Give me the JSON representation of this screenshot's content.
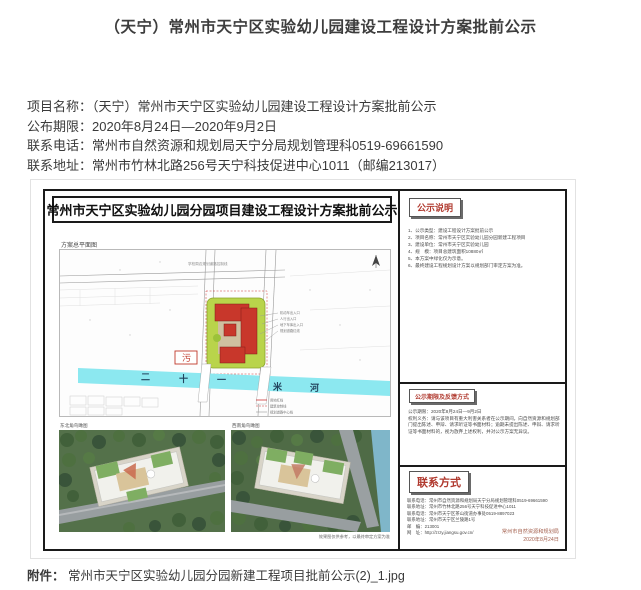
{
  "page": {
    "title": "（天宁）常州市天宁区实验幼儿园建设工程设计方案批前公示",
    "info": [
      {
        "label": "项目名称：",
        "value": "（天宁）常州市天宁区实验幼儿园建设工程设计方案批前公示"
      },
      {
        "label": "公布期限：",
        "value": "2020年8月24日—2020年9月2日"
      },
      {
        "label": "联系电话：",
        "value": "常州市自然资源和规划局天宁分局规划管理科0519-69661590"
      },
      {
        "label": "联系地址：",
        "value": "常州市竹林北路256号天宁科技促进中心1011（邮编213017）"
      }
    ],
    "attachment_label": "附件：",
    "attachment_name": "常州市天宁区实验幼儿园分园新建工程项目批前公示(2)_1.jpg"
  },
  "poster": {
    "banner": "常州市天宁区实验幼儿园分园项目建设工程设计方案批前公示",
    "site_plan": {
      "label": "方案总平面图",
      "note": "学校周边规划道路控制线",
      "sewage_marker": "污",
      "river_chars": [
        "二",
        "十",
        "一",
        "米",
        "河"
      ],
      "callouts": [
        "机动车出入口",
        "人行出入口",
        "地下车库出入口",
        "规划道路红线"
      ],
      "legend": [
        "用地红线",
        "建筑控制线",
        "规划道路中心线"
      ]
    },
    "renderings": [
      {
        "label": "东北角鸟瞰图"
      },
      {
        "label": "西南角鸟瞰图"
      }
    ],
    "rendering_note": "效果图仅供参考，以最终审定方案为准",
    "sections": {
      "notes": {
        "title": "公示说明",
        "items": [
          "1、公示类型：建设工程设计方案批前公示",
          "2、项目名称：常州市天宁区实验幼儿园分园新建工程项目",
          "3、建设单位：常州市天宁区实验幼儿园",
          "4、规　模：项目总建筑面积10880㎡",
          "5、本方案中绿化仅为示意。",
          "6、最终建设工程规划设计方案以规划部门审定方案为准。"
        ]
      },
      "feedback": {
        "title": "公示期限及反馈方式",
        "line1": "公示期限：2020年8月24日—9月2日",
        "line2": "权利义务：请与该项目有重大利害关系者在公示期间，向自然资源和规划部门提出陈述、申辩、请求听证等书面材料；逾期未提出陈述、申辩、请求听证等书面材料的，视为放弃上述权利，并对公示方案无异议。"
      },
      "contact": {
        "title": "联系方式",
        "lines": [
          "联系电话：常州市自然资源和规划局天宁分局规划管理科0519-69661590",
          "联系地址：常州市竹林北路256号天宁科技促进中心1011",
          "联系电话：常州市天宁区茶山街道办事处0519-8897023",
          "联系地址：常州市天宁区兰陵路1号",
          "邮　编：213001",
          "网　址：http://zrzy.jiangsu.gov.cn/"
        ],
        "agency": "常州市自然资源和规划局",
        "date": "2020年8月24日"
      }
    }
  },
  "colors": {
    "accent_red": "#b0392e",
    "river_cyan": "#8ce8f0",
    "site_green": "#b9d44b",
    "building_red": "#c8372b"
  }
}
